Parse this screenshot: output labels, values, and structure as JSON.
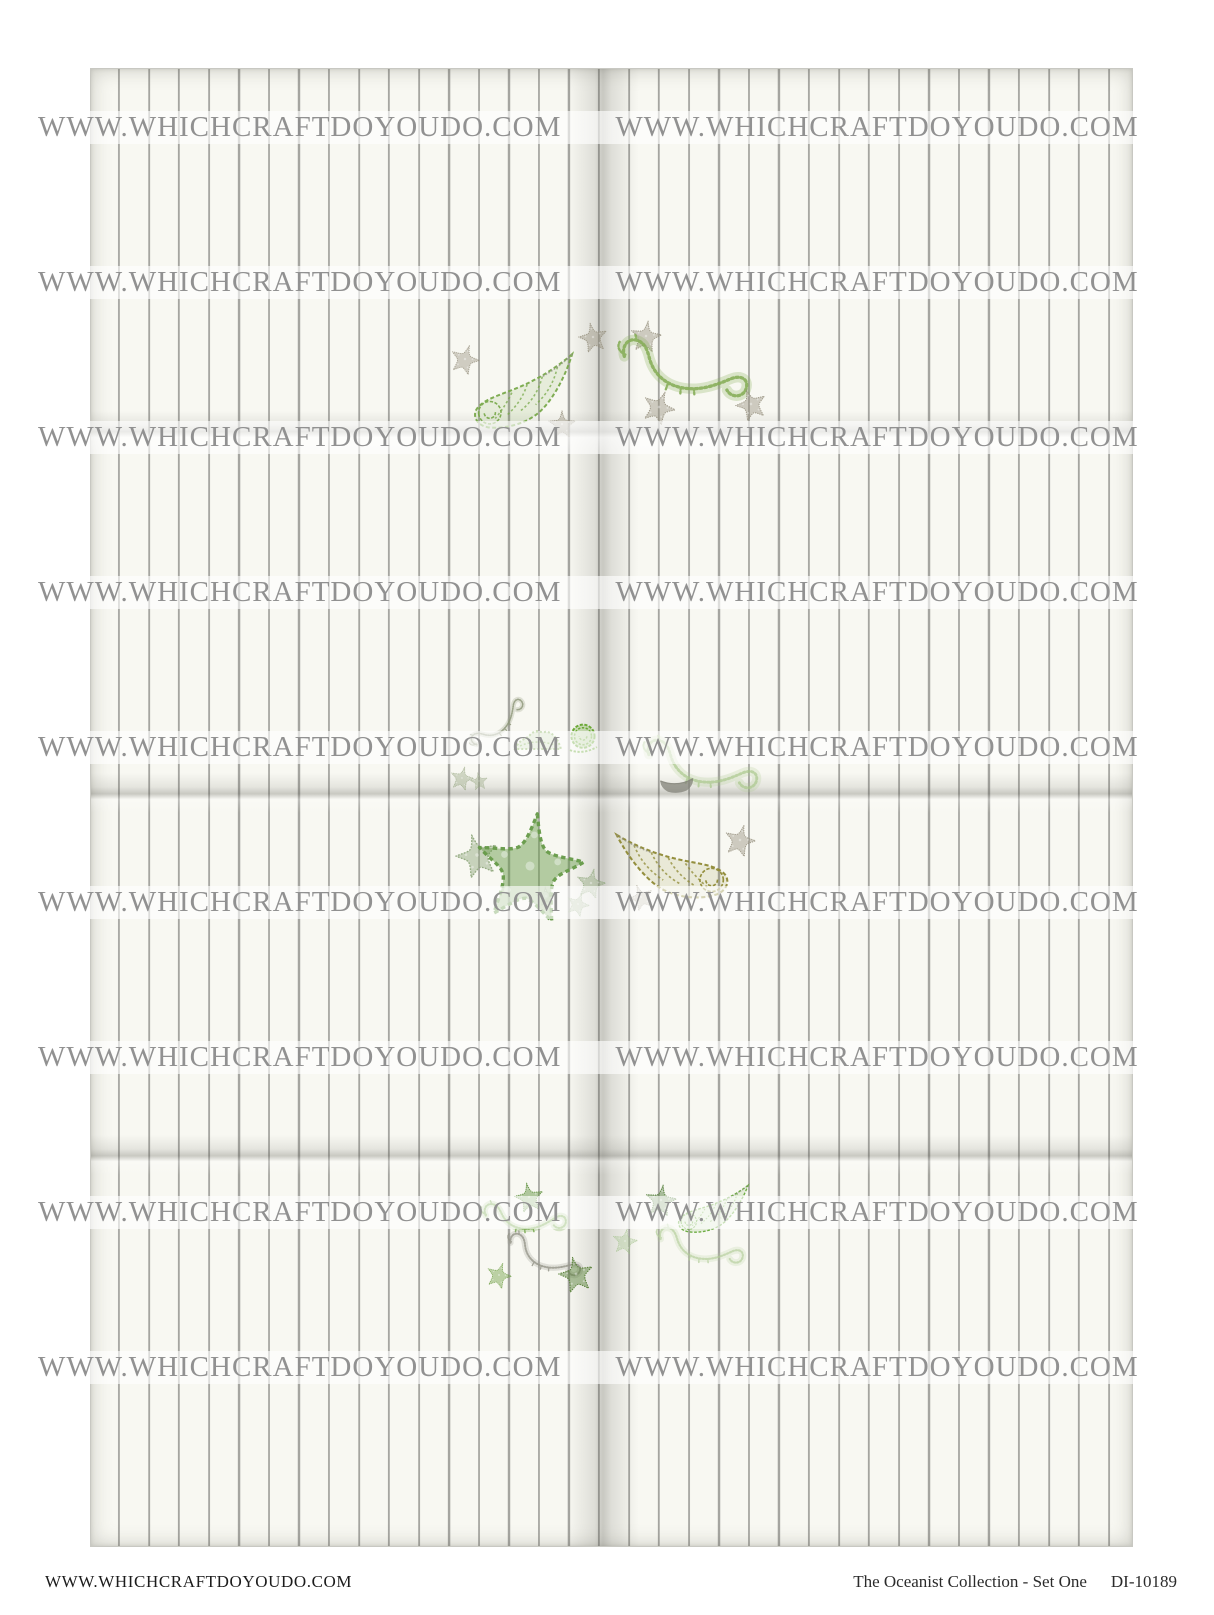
{
  "page": {
    "width": 1214,
    "height": 1615,
    "background": "#ffffff"
  },
  "sheet": {
    "description": "pinstriped cream craft paper divided into 8 fold panels (2 columns x 4 rows)",
    "paper_color": "#f8f8f2",
    "stripe_color": "#a5a5a0",
    "stripe_spacing_px": 30
  },
  "watermark": {
    "text": "WWW.WHICHCRAFTDOYOUDO.COM",
    "color": "#919191",
    "rows": 9,
    "first_top": 111,
    "row_spacing": 155,
    "band_height": 33
  },
  "footer": {
    "left_text": "WWW.WHICHCRAFTDOYOUDO.COM",
    "title": "The Oceanist Collection - Set One",
    "code": "DI-10189",
    "color": "#2b2b2b"
  },
  "palette": {
    "sketch_green": "#6fa747",
    "sketch_olive": "#8f8a35",
    "sketch_gray": "#97917f",
    "accent_bright_green": "#64a52c"
  },
  "illustrations": [
    {
      "name": "starfish-sketch",
      "type": "starfish",
      "x": 450,
      "y": 344,
      "w": 30,
      "h": 30,
      "rot": 18,
      "color": "#97917f",
      "opacity": 0.85
    },
    {
      "name": "conch-shell-sketch",
      "type": "conch",
      "x": 462,
      "y": 350,
      "w": 120,
      "h": 80,
      "rot": -6,
      "flip": true,
      "color": "#79a94b",
      "opacity": 0.95
    },
    {
      "name": "starfish-sketch",
      "type": "starfish",
      "x": 578,
      "y": 322,
      "w": 30,
      "h": 30,
      "rot": -12,
      "color": "#97917f",
      "opacity": 0.9
    },
    {
      "name": "starfish-sketch",
      "type": "starfish",
      "x": 630,
      "y": 320,
      "w": 32,
      "h": 32,
      "rot": 8,
      "color": "#97917f",
      "opacity": 0.9
    },
    {
      "name": "seahorse-sketch",
      "type": "seahorse",
      "x": 612,
      "y": 336,
      "w": 142,
      "h": 66,
      "rot": 4,
      "color": "#85ad56",
      "opacity": 0.9
    },
    {
      "name": "starfish-sketch",
      "type": "starfish",
      "x": 548,
      "y": 410,
      "w": 28,
      "h": 28,
      "rot": 0,
      "color": "#97917f",
      "opacity": 0.9
    },
    {
      "name": "starfish-sketch",
      "type": "starfish",
      "x": 642,
      "y": 390,
      "w": 34,
      "h": 34,
      "rot": 22,
      "color": "#97917f",
      "opacity": 0.9
    },
    {
      "name": "starfish-sketch",
      "type": "starfish",
      "x": 735,
      "y": 388,
      "w": 32,
      "h": 32,
      "rot": -18,
      "color": "#97917f",
      "opacity": 0.9
    },
    {
      "name": "seahorse-sketch",
      "type": "seahorse",
      "x": 462,
      "y": 700,
      "w": 70,
      "h": 46,
      "rot": -55,
      "color": "#8d9678",
      "opacity": 0.85
    },
    {
      "name": "shell-ridge-sketch",
      "type": "bump",
      "x": 512,
      "y": 726,
      "w": 52,
      "h": 26,
      "rot": 0,
      "color": "#79a94b",
      "opacity": 0.9
    },
    {
      "name": "snail-shell-sketch",
      "type": "snail",
      "x": 566,
      "y": 720,
      "w": 34,
      "h": 34,
      "rot": 0,
      "color": "#64a52c",
      "opacity": 0.95
    },
    {
      "name": "starfish-sketch",
      "type": "starfish",
      "x": 450,
      "y": 766,
      "w": 24,
      "h": 24,
      "rot": 14,
      "color": "#93a37e",
      "opacity": 0.8
    },
    {
      "name": "starfish-sketch",
      "type": "starfish",
      "x": 470,
      "y": 772,
      "w": 18,
      "h": 18,
      "rot": -8,
      "color": "#93a37e",
      "opacity": 0.8
    },
    {
      "name": "seahorse-sketch",
      "type": "seahorse",
      "x": 628,
      "y": 736,
      "w": 145,
      "h": 58,
      "rot": 3,
      "color": "#a9c78b",
      "opacity": 0.75
    },
    {
      "name": "clam-shell-sketch",
      "type": "clam",
      "x": 658,
      "y": 775,
      "w": 38,
      "h": 20,
      "rot": -4,
      "color": "#85857b",
      "opacity": 0.9
    },
    {
      "name": "starfish-sketch",
      "type": "starfish",
      "x": 455,
      "y": 833,
      "w": 44,
      "h": 44,
      "rot": -15,
      "color": "#8ba478",
      "opacity": 0.9
    },
    {
      "name": "starfish-sketch",
      "type": "starfish",
      "x": 474,
      "y": 810,
      "w": 112,
      "h": 112,
      "rot": 8,
      "color": "#659a47",
      "opacity": 0.95
    },
    {
      "name": "starfish-sketch",
      "type": "starfish",
      "x": 576,
      "y": 868,
      "w": 30,
      "h": 30,
      "rot": 12,
      "color": "#8ba478",
      "opacity": 0.85
    },
    {
      "name": "starfish-sketch",
      "type": "starfish",
      "x": 536,
      "y": 886,
      "w": 20,
      "h": 20,
      "rot": -5,
      "color": "#8ba478",
      "opacity": 0.8
    },
    {
      "name": "starfish-sketch",
      "type": "starfish",
      "x": 566,
      "y": 892,
      "w": 24,
      "h": 24,
      "rot": 20,
      "color": "#8ba478",
      "opacity": 0.8
    },
    {
      "name": "conch-shell-sketch",
      "type": "conch",
      "x": 612,
      "y": 820,
      "w": 125,
      "h": 85,
      "rot": -4,
      "flip": false,
      "color": "#8f8a35",
      "opacity": 0.95
    },
    {
      "name": "starfish-sketch",
      "type": "starfish",
      "x": 724,
      "y": 824,
      "w": 32,
      "h": 32,
      "rot": 15,
      "color": "#97917f",
      "opacity": 0.9
    },
    {
      "name": "starfish-sketch",
      "type": "starfish",
      "x": 628,
      "y": 884,
      "w": 26,
      "h": 26,
      "rot": -20,
      "color": "#97917f",
      "opacity": 0.85
    },
    {
      "name": "starfish-sketch",
      "type": "starfish",
      "x": 514,
      "y": 1182,
      "w": 30,
      "h": 30,
      "rot": -10,
      "color": "#5d8f3c",
      "opacity": 0.95
    },
    {
      "name": "seahorse-sketch",
      "type": "seahorse",
      "x": 474,
      "y": 1196,
      "w": 100,
      "h": 42,
      "rot": -6,
      "color": "#77a94e",
      "opacity": 0.9
    },
    {
      "name": "seahorse-sketch",
      "type": "seahorse",
      "x": 502,
      "y": 1232,
      "w": 84,
      "h": 46,
      "rot": 12,
      "color": "#96968a",
      "opacity": 0.85
    },
    {
      "name": "starfish-sketch",
      "type": "starfish",
      "x": 486,
      "y": 1262,
      "w": 26,
      "h": 26,
      "rot": 18,
      "color": "#6f9f46",
      "opacity": 0.9
    },
    {
      "name": "starfish-sketch",
      "type": "starfish",
      "x": 558,
      "y": 1256,
      "w": 36,
      "h": 36,
      "rot": -12,
      "color": "#567f36",
      "opacity": 0.95
    },
    {
      "name": "starfish-sketch",
      "type": "starfish",
      "x": 612,
      "y": 1228,
      "w": 26,
      "h": 26,
      "rot": 10,
      "color": "#9ebf85",
      "opacity": 0.7
    },
    {
      "name": "starfish-sketch",
      "type": "starfish",
      "x": 645,
      "y": 1184,
      "w": 32,
      "h": 32,
      "rot": 8,
      "color": "#4e7a35",
      "opacity": 0.95
    },
    {
      "name": "conch-shell-sketch",
      "type": "conch",
      "x": 662,
      "y": 1180,
      "w": 100,
      "h": 55,
      "rot": -2,
      "flip": true,
      "color": "#66a93a",
      "opacity": 0.95
    },
    {
      "name": "seahorse-sketch",
      "type": "seahorse",
      "x": 630,
      "y": 1224,
      "w": 140,
      "h": 44,
      "rot": 2,
      "color": "#b2cd97",
      "opacity": 0.7
    }
  ]
}
